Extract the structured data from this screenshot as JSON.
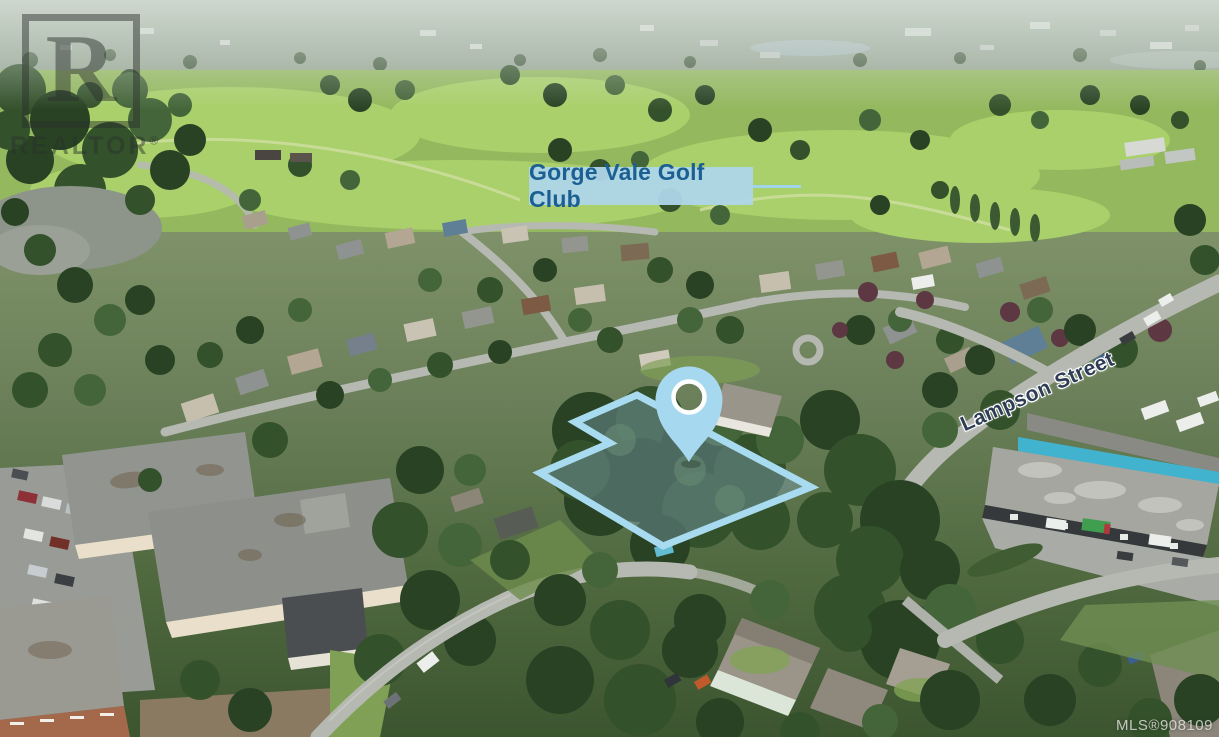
{
  "annotations": {
    "watermark": {
      "logo_letter": "R",
      "label": "REALTOR",
      "registered_mark": "®"
    },
    "golf_club_label": {
      "text": "Gorge Vale Golf Club"
    },
    "street_label": {
      "text": "Lampson Street"
    },
    "mls_badge": {
      "text": "MLS®908109"
    }
  },
  "colors": {
    "annotation_blue": "#a6d9ef",
    "property_fill": "rgba(127,163,180,0.42)",
    "label_background": "rgba(174,214,233,0.95)",
    "label_text": "#1c5f93",
    "street_text": "#2e3d55"
  },
  "scene": {
    "description": "Aerial drone photo of a treed suburban property outlined in blue with a map pin, golf course and neighbourhood beyond"
  }
}
